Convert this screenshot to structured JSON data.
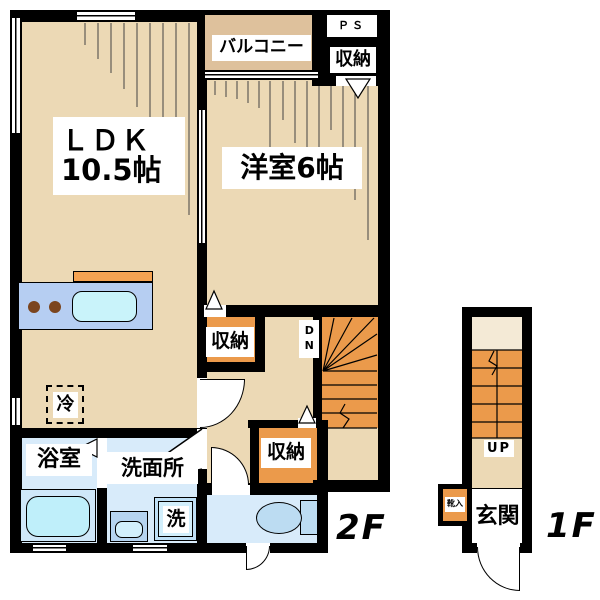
{
  "unit_2f": {
    "floor_label": "2F",
    "ldk_name": "ＬＤＫ",
    "ldk_size": "10.5帖",
    "bedroom_label": "洋室6帖",
    "balcony_label": "バルコニー",
    "ps_label": "ＰＳ",
    "storage_top_label": "収納",
    "storage_mid_label": "収納",
    "storage_bottom_label": "収納",
    "bathroom_label": "浴室",
    "washroom_label": "洗面所",
    "washer_label": "洗",
    "fridge_label": "冷",
    "stairs_down_label": "DN"
  },
  "unit_1f": {
    "floor_label": "1F",
    "entrance_label": "玄関",
    "shoe_cabinet_label": "靴入",
    "stairs_up_label": "UP"
  },
  "colors": {
    "floor_beige": "#ecd9b5",
    "balcony_tan": "#dec19c",
    "storage_orange": "#eb9a4b",
    "wet_area_blue": "#d8ebfa",
    "kitchen_counter_blue": "#b6cef2",
    "sink_cyan": "#c9f3fa",
    "toilet_blue": "#bcdcf2",
    "entry_landing_cream": "#f4ead6",
    "wall_black": "#000000"
  }
}
